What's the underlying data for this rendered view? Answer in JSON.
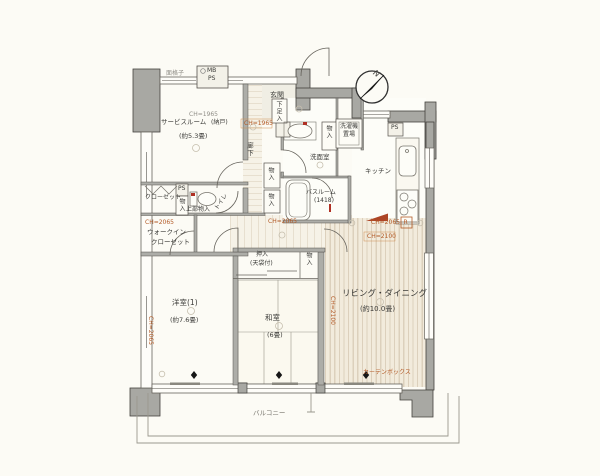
{
  "colors": {
    "wall_gray": "#a8a8a3",
    "line_dark": "#55524c",
    "ch_label_orange": "#b35a26",
    "red_accent": "#ad4526",
    "floor_stripe": "#dcd0bc",
    "background": "#fcfbf5"
  },
  "compass": {
    "north_label": "N"
  },
  "rooms": {
    "entrance": {
      "name": "玄関",
      "shoe_box": "下足入",
      "meter_box": "MB",
      "pipe_space": "PS",
      "lattice": "面格子",
      "ceiling": "CH=1965"
    },
    "service_room": {
      "name": "サービスルーム",
      "note": "(納戸)",
      "size": "(約5.3畳)",
      "ceiling": "CH=1965"
    },
    "hallway": {
      "name": "廊下"
    },
    "closet": {
      "name": "クローゼット"
    },
    "walk_in_closet": {
      "line1": "ウォークイン",
      "line2": "クローゼット",
      "ceiling": "CH=2065"
    },
    "toilet": {
      "name": "トイレ",
      "upper_storage": "上部物入",
      "pipe_space": "PS",
      "side_storage": "物入"
    },
    "western_room": {
      "name": "洋室(1)",
      "size": "(約7.6畳)",
      "ceiling": "CH=2065"
    },
    "washroom": {
      "name": "洗面室"
    },
    "bathroom": {
      "name": "バスルーム",
      "size": "(1418)"
    },
    "laundry": {
      "line1": "洗濯機",
      "line2": "置場"
    },
    "storage_hall_1": {
      "name": "物入"
    },
    "storage_hall_2": {
      "name": "物入"
    },
    "storage_washroom": {
      "name": "物入"
    },
    "corridor": {
      "ceiling": "CH=2065"
    },
    "kitchen": {
      "name": "キッチン",
      "pipe_space": "PS",
      "refrigerator": "R"
    },
    "living_dining": {
      "name": "リビング・ダイニング",
      "size": "(約10.0畳)",
      "ceiling_a": "CH=2065",
      "ceiling_b": "CH=2100",
      "ceiling_side": "CH=2100",
      "curtain_box": "カーテンボックス"
    },
    "japanese_room": {
      "name": "和室",
      "size": "(6畳)",
      "oshiire": "押入",
      "oshiire_note": "(天袋付)",
      "storage": "物入"
    },
    "balcony": {
      "name": "バルコニー"
    }
  }
}
